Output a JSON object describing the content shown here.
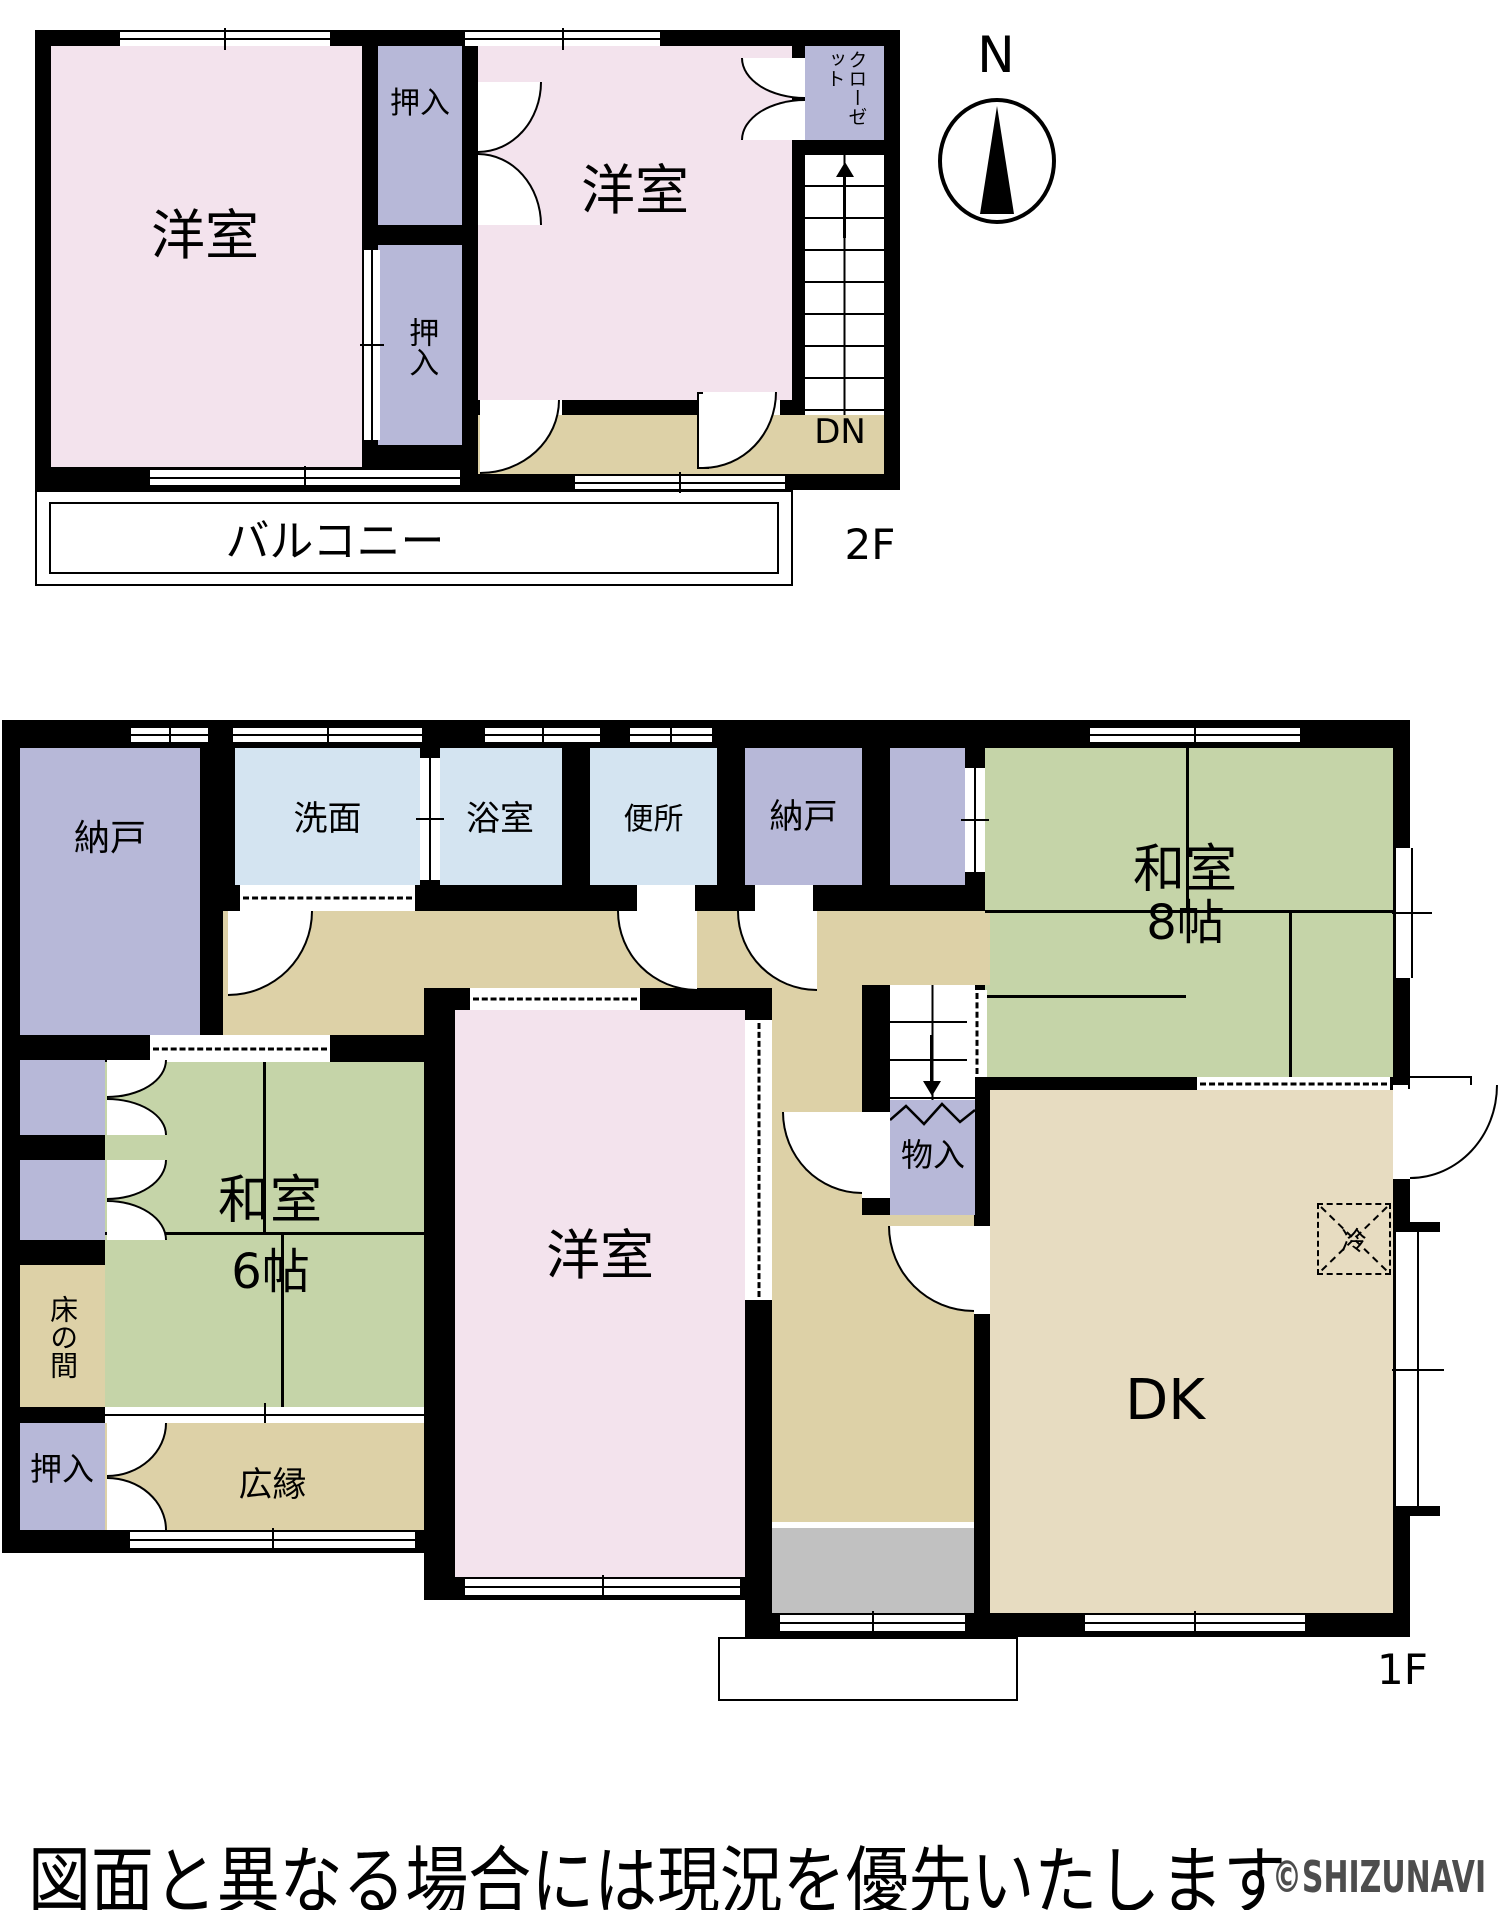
{
  "floor2": {
    "label": "2F",
    "rooms": {
      "yoshitsu_left": "洋室",
      "yoshitsu_right": "洋室",
      "oshiire_top": "押入",
      "oshiire_mid": "押入",
      "closet": "クローゼット",
      "stairs_down": "DN",
      "balcony": "バルコニー"
    }
  },
  "floor1": {
    "label": "1F",
    "rooms": {
      "nando_left": "納戸",
      "senmen": "洗面",
      "yokushitsu": "浴室",
      "benjo": "便所",
      "nando_top": "納戸",
      "washitsu8_name": "和室",
      "washitsu8_size": "8帖",
      "washitsu6_name": "和室",
      "washitsu6_size": "6帖",
      "yoshitsu": "洋室",
      "monoire": "物入",
      "dk": "DK",
      "refrigerator": "冷",
      "tokonoma": "床の間",
      "oshiire": "押入",
      "hiroen": "広縁"
    }
  },
  "compass": {
    "north": "N"
  },
  "footer": {
    "notice": "図面と異なる場合には現況を優先いたします",
    "watermark": "©SHIZUNAVI"
  }
}
